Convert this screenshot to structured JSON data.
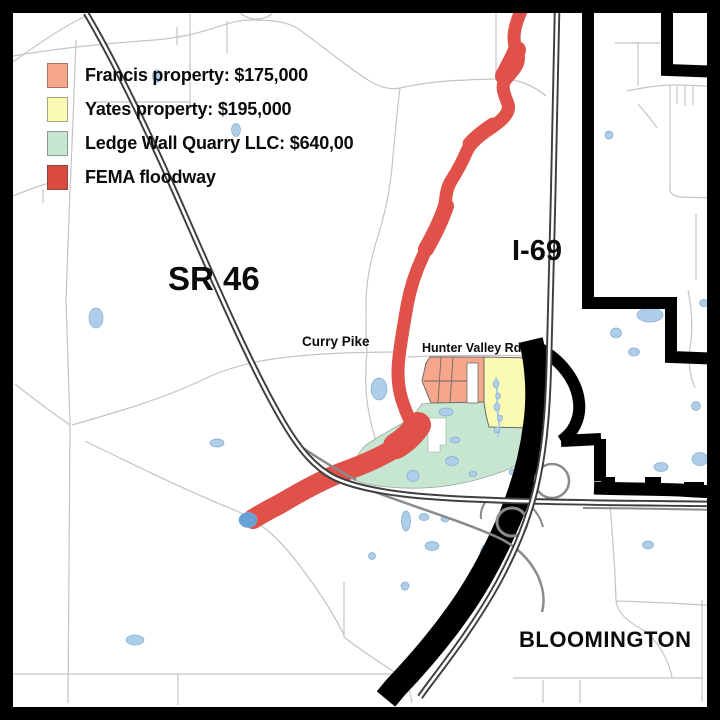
{
  "map": {
    "legend": {
      "items": [
        {
          "label": "Francis property: $175,000",
          "color": "#F6A68A"
        },
        {
          "label": "Yates property: $195,000",
          "color": "#FAFAB2"
        },
        {
          "label": "Ledge Wall Quarry LLC: $640,00",
          "color": "#C6E6D2"
        },
        {
          "label": "FEMA floodway",
          "color": "#DC4B42"
        }
      ]
    },
    "labels": {
      "highway_sr46": "SR 46",
      "highway_i69": "I-69",
      "road_curry_pike": "Curry Pike",
      "road_hunter_valley": "Hunter Valley Rd",
      "city": "BLOOMINGTON"
    },
    "colors": {
      "francis": "#F6A68A",
      "yates": "#FAFAB2",
      "quarry": "#C6E6D2",
      "floodway": "#E0514A",
      "pond": "#AECDE9",
      "pond_edge": "#85ABCF",
      "pond_dark": "#68A0D8",
      "road_thin": "#C4C4C4",
      "road_major": "#3F3F3F",
      "ramp": "#8A8A8A",
      "boundary": "#000000"
    }
  }
}
